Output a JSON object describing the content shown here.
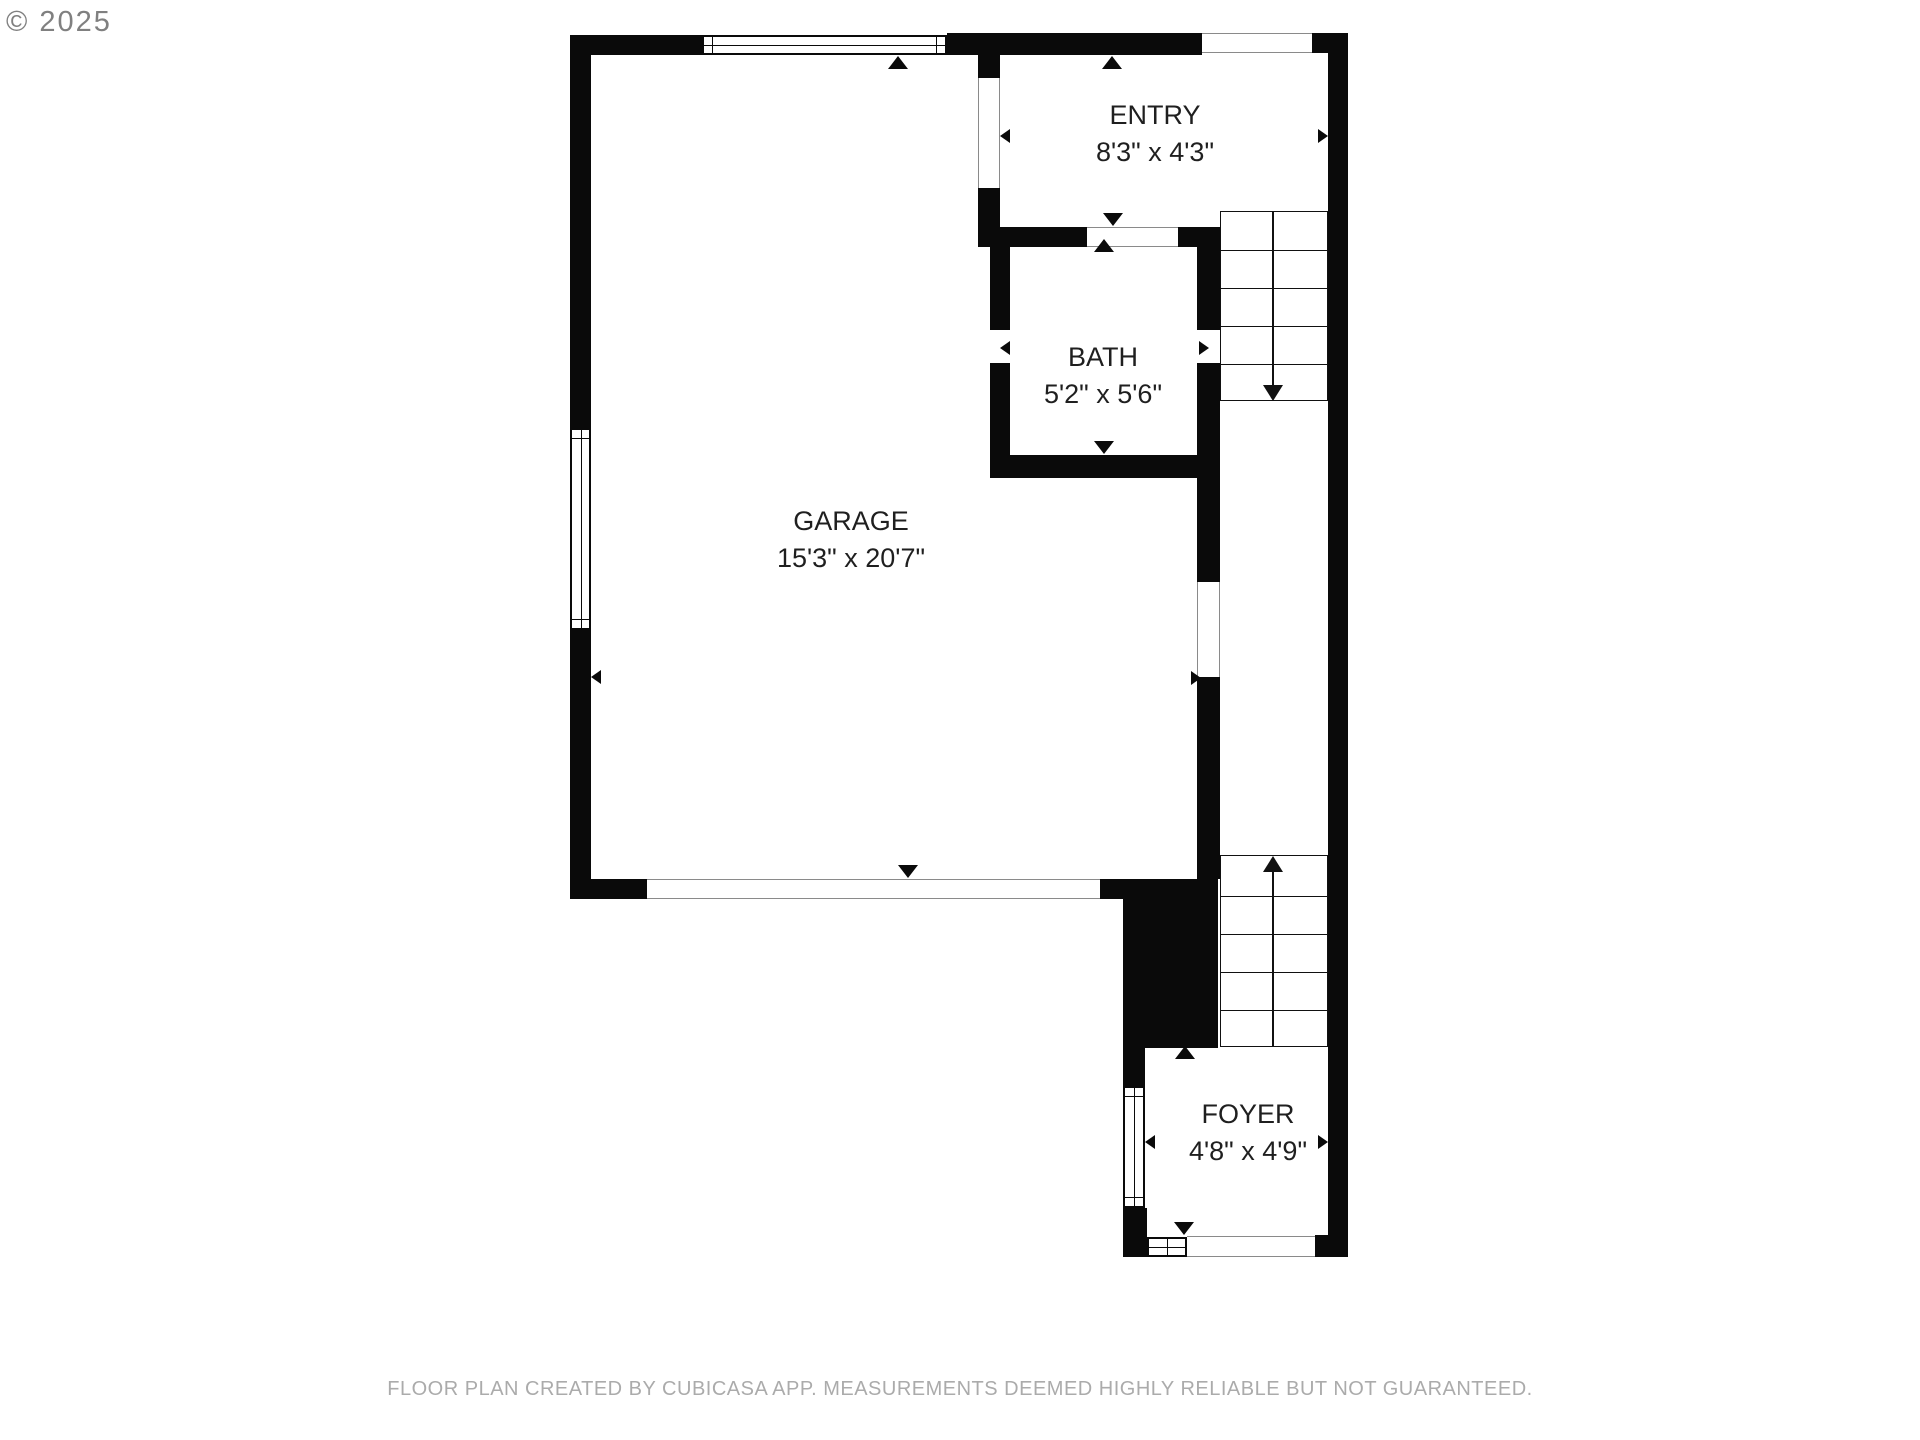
{
  "watermark": "© 2025",
  "disclaimer": "FLOOR PLAN CREATED BY CUBICASA APP. MEASUREMENTS DEEMED HIGHLY RELIABLE BUT NOT GUARANTEED.",
  "rooms": [
    {
      "name": "ENTRY",
      "dimensions": "8'3\" x 4'3\""
    },
    {
      "name": "BATH",
      "dimensions": "5'2\" x 5'6\""
    },
    {
      "name": "GARAGE",
      "dimensions": "15'3\" x 20'7\""
    },
    {
      "name": "FOYER",
      "dimensions": "4'8\" x 4'9\""
    }
  ],
  "stairs": [
    {
      "location": "upper-right",
      "direction": "down",
      "steps": 5
    },
    {
      "location": "lower-right",
      "direction": "up",
      "steps": 5
    }
  ],
  "colors": {
    "wall": "#0a0a0a",
    "label_text": "#1f1f1f",
    "watermark": "#808080",
    "disclaimer": "#ababab"
  }
}
